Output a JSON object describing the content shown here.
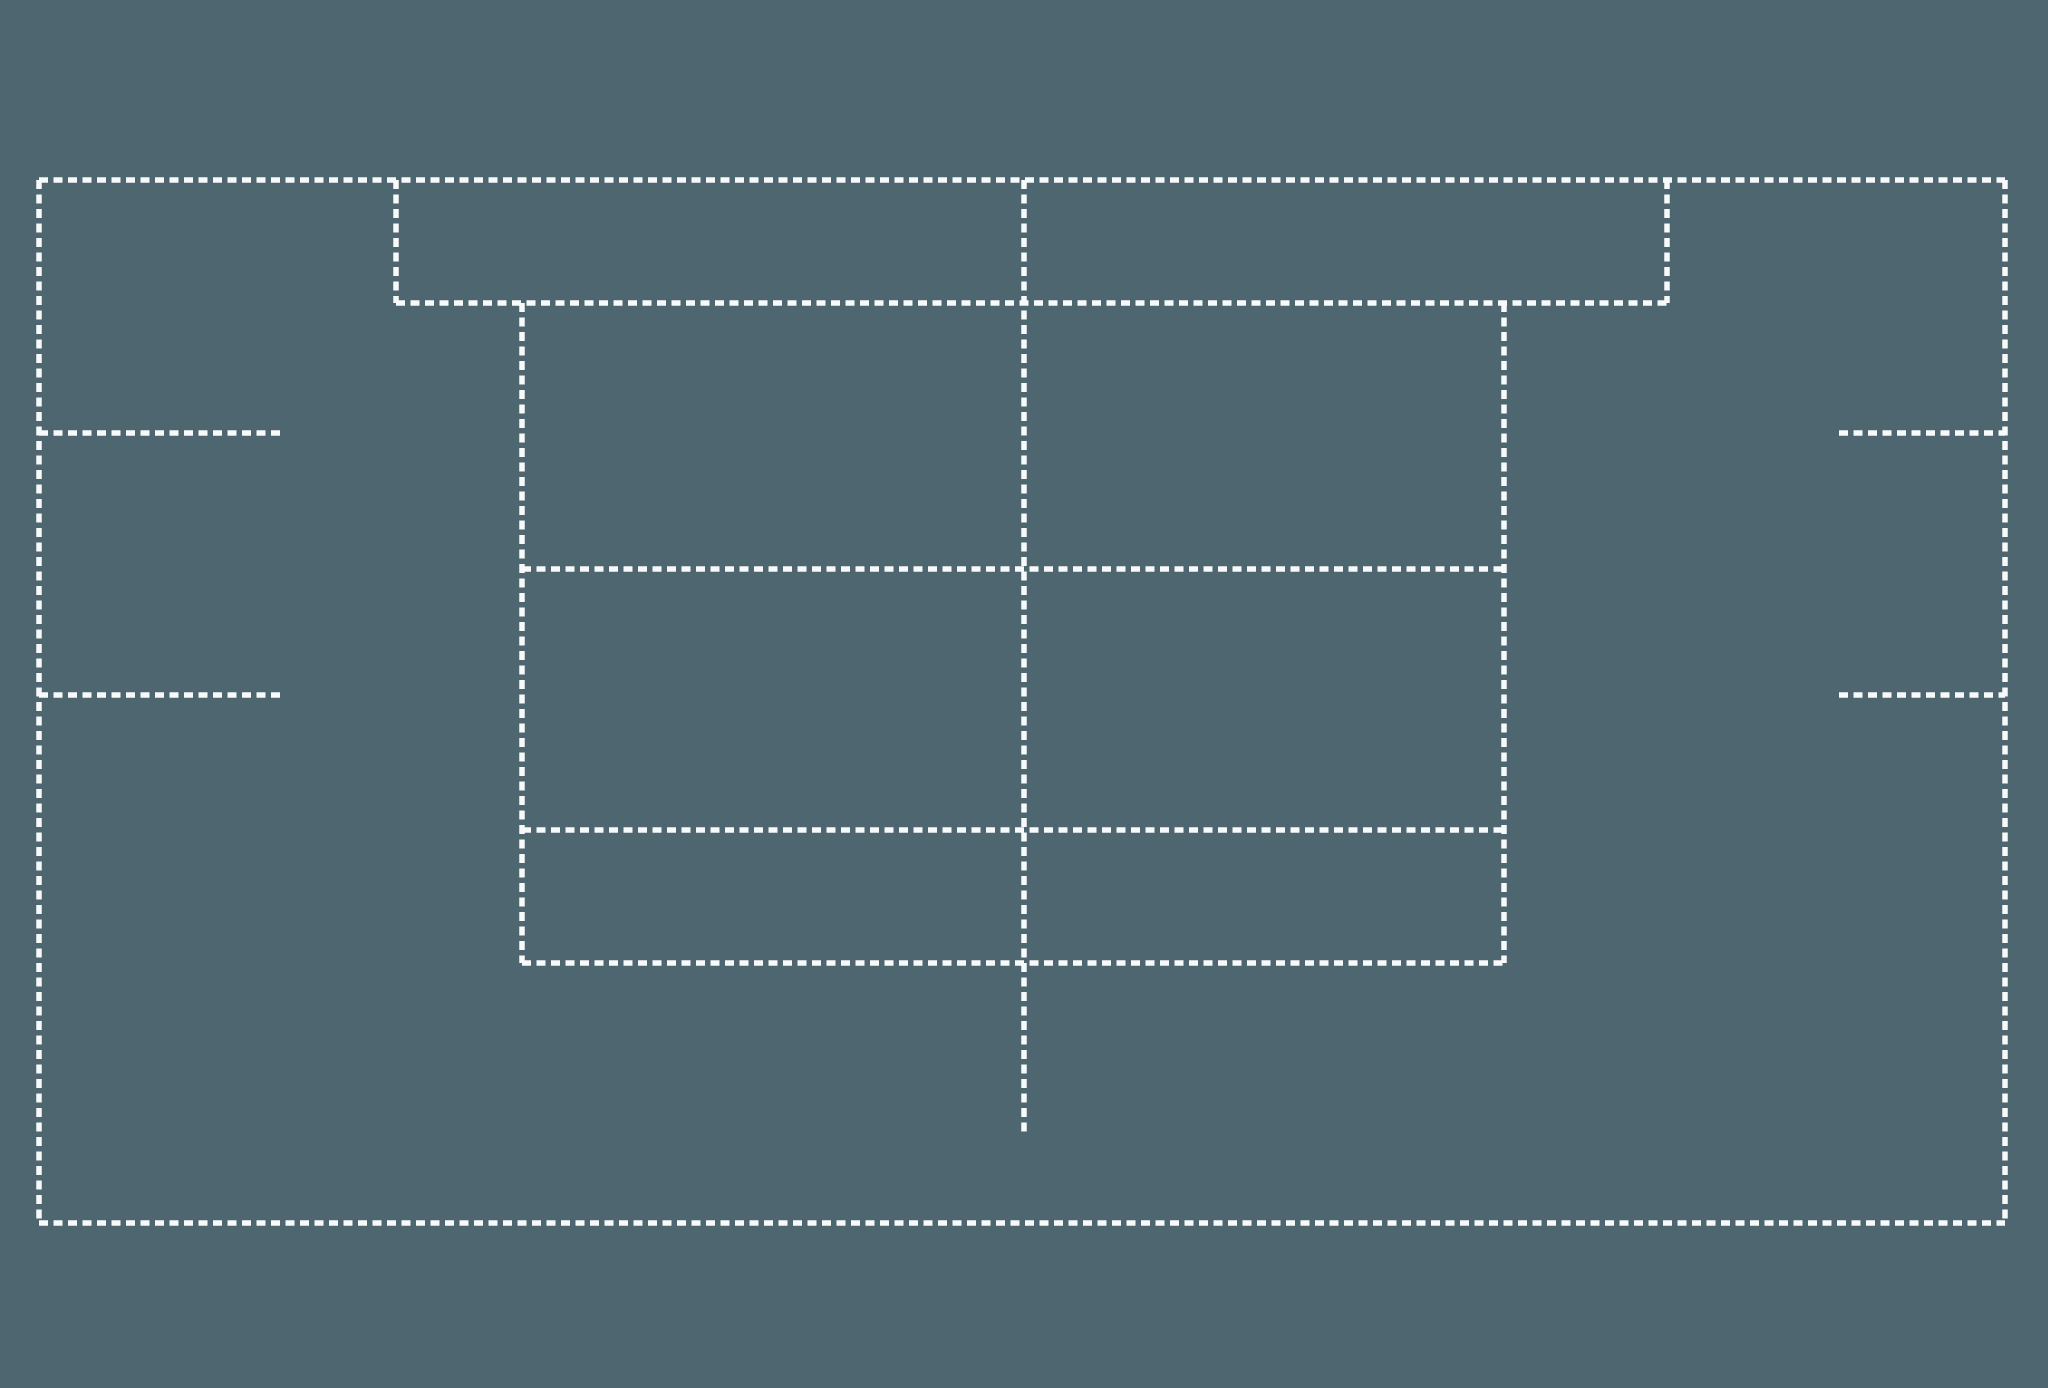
{
  "canvas": {
    "width": 2048,
    "height": 1388
  },
  "colors": {
    "background": "#4d6670",
    "line": "#f7f9fa"
  },
  "stroke": {
    "width": 5.5,
    "dasharray": "9 5.5"
  },
  "segments": [
    {
      "name": "outer-top-edge",
      "x1": 39,
      "y1": 180,
      "x2": 2005,
      "y2": 180
    },
    {
      "name": "outer-bottom-edge",
      "x1": 39,
      "y1": 1223,
      "x2": 2005,
      "y2": 1223
    },
    {
      "name": "outer-left-edge",
      "x1": 39,
      "y1": 180,
      "x2": 39,
      "y2": 1223
    },
    {
      "name": "outer-right-edge",
      "x1": 2005,
      "y1": 180,
      "x2": 2005,
      "y2": 1223
    },
    {
      "name": "header-left-edge",
      "x1": 396,
      "y1": 180,
      "x2": 396,
      "y2": 303
    },
    {
      "name": "header-right-edge",
      "x1": 1667,
      "y1": 180,
      "x2": 1667,
      "y2": 303
    },
    {
      "name": "header-bottom-edge",
      "x1": 396,
      "y1": 303,
      "x2": 1667,
      "y2": 303
    },
    {
      "name": "center-divider",
      "x1": 1024,
      "y1": 180,
      "x2": 1024,
      "y2": 1133
    },
    {
      "name": "table-left-edge",
      "x1": 522,
      "y1": 303,
      "x2": 522,
      "y2": 963
    },
    {
      "name": "table-right-edge",
      "x1": 1504,
      "y1": 303,
      "x2": 1504,
      "y2": 963
    },
    {
      "name": "table-row-divider-1",
      "x1": 522,
      "y1": 569,
      "x2": 1504,
      "y2": 569
    },
    {
      "name": "table-row-divider-2",
      "x1": 522,
      "y1": 830,
      "x2": 1504,
      "y2": 830
    },
    {
      "name": "table-bottom-edge",
      "x1": 522,
      "y1": 963,
      "x2": 1504,
      "y2": 963
    },
    {
      "name": "left-rail-tick-1",
      "x1": 39,
      "y1": 433,
      "x2": 280,
      "y2": 433
    },
    {
      "name": "left-rail-tick-2",
      "x1": 39,
      "y1": 695,
      "x2": 280,
      "y2": 695
    },
    {
      "name": "right-rail-tick-1",
      "x1": 1839,
      "y1": 433,
      "x2": 2005,
      "y2": 433
    },
    {
      "name": "right-rail-tick-2",
      "x1": 1839,
      "y1": 695,
      "x2": 2005,
      "y2": 695
    }
  ]
}
